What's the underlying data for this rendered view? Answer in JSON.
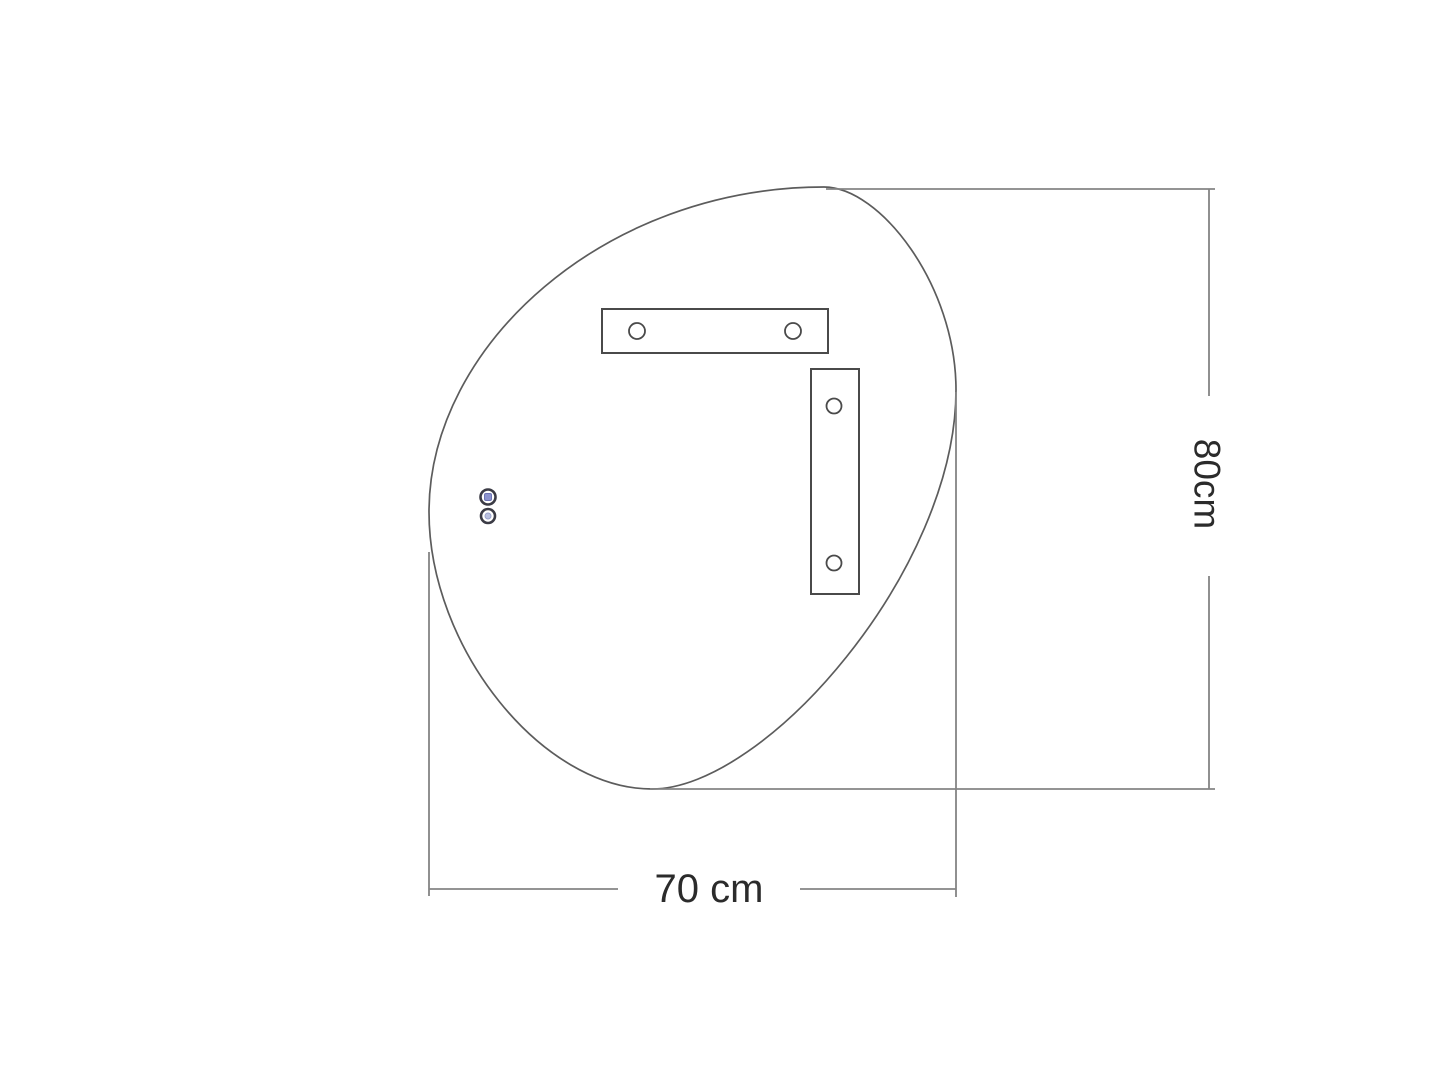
{
  "drawing_type": "technical-dimension-diagram",
  "labels": {
    "height": "80cm",
    "width": "70 cm"
  },
  "icons": {
    "sensor_top": "touch-sensor-icon",
    "sensor_bottom": "light-sensor-icon"
  },
  "colors": {
    "background": "#ffffff",
    "outline": "#5c5c5c",
    "bracket": "#4a4a4a",
    "dimension_line": "#848484",
    "label_text": "#2b2b2b",
    "sensor_ring": "#3b3b45",
    "sensor_fill_top": "#8d94cf",
    "sensor_fill_bottom": "#bac1e0"
  },
  "dimensions": {
    "height_cm": 80,
    "width_cm": 70
  }
}
